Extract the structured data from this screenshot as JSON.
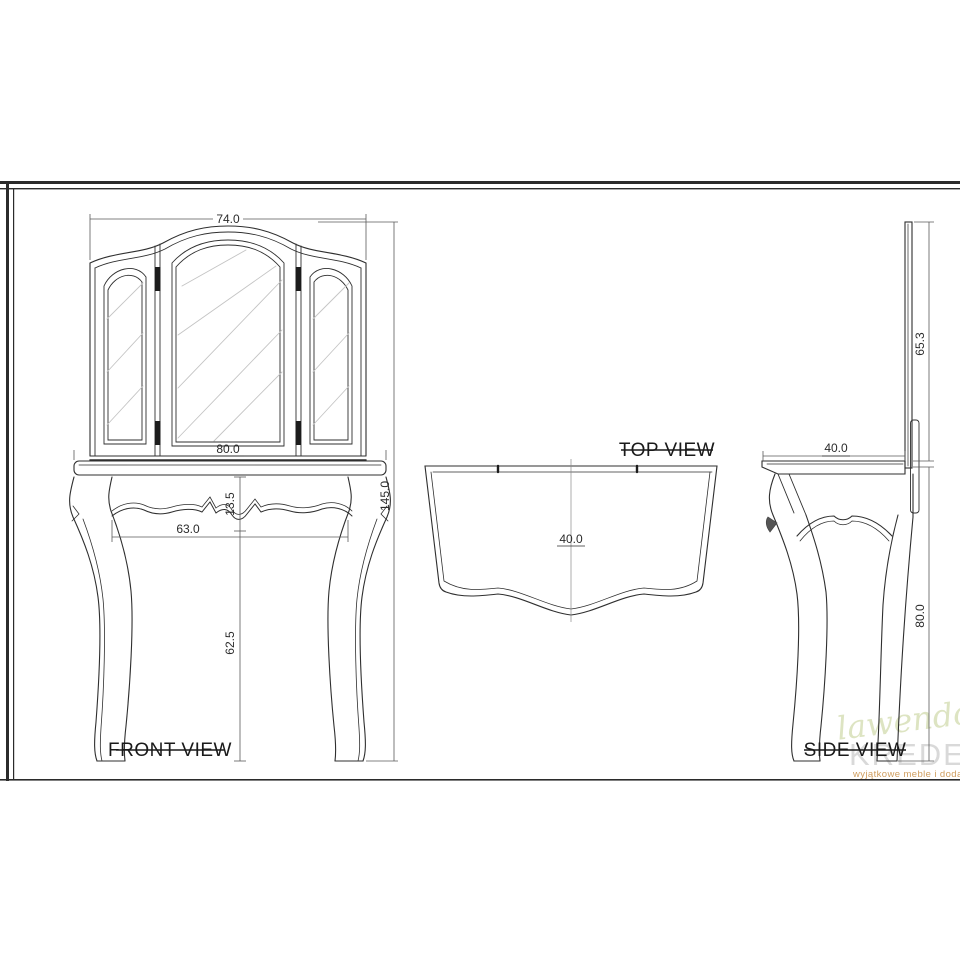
{
  "views": {
    "front": {
      "label": "FRONT VIEW",
      "dims": {
        "mirror_width": "74.0",
        "top_width": "80.0",
        "overall_height": "145.0",
        "apron_height": "13.5",
        "leg_span": "63.0",
        "leg_height": "62.5"
      }
    },
    "top": {
      "label": "TOP VIEW",
      "dims": {
        "depth": "40.0"
      }
    },
    "side": {
      "label": "SIDE VIEW",
      "dims": {
        "mirror_height": "65.3",
        "top_depth": "40.0",
        "table_height": "80.0"
      }
    }
  },
  "watermark": {
    "script_text": "lawendowy",
    "brand": "KREDENS",
    "suffix": ".pl",
    "tagline": "wyjątkowe meble i dodatki"
  },
  "colors": {
    "line": "#2f2f2f",
    "dim_line": "#5a5a5a",
    "hatch": "#c4c4c4",
    "watermark_script": "#dde4c2",
    "watermark_brand": "#d9d9d9",
    "watermark_accent": "#d2a05f"
  }
}
